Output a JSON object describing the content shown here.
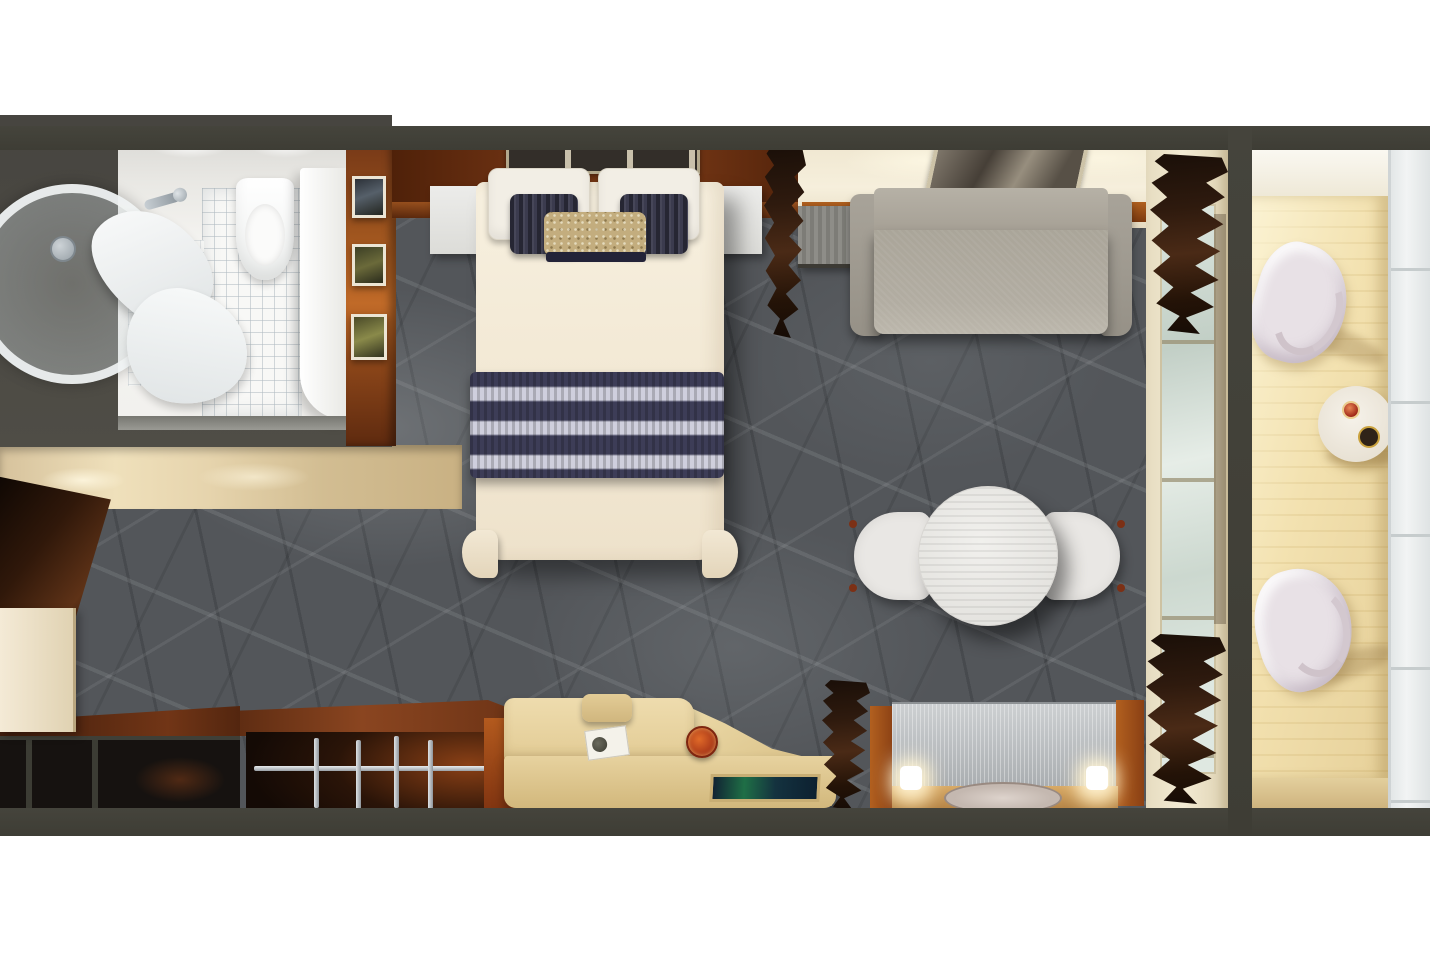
{
  "scene": {
    "kind": "3d-rendered-floor-plan",
    "view": "top-down",
    "subject": "balcony-stateroom-cabin",
    "visible_text": ""
  },
  "palette": {
    "background": "#ffffff",
    "wall": "#45443c",
    "carpet": "#54575b",
    "carpet_vein": "#9ba1a4",
    "wood_dark": "#5b2b10",
    "wood_glow": "#bb6526",
    "cream_wall": "#f1e8d2",
    "bed_linen": "#f5eedd",
    "navy_accent": "#39394e",
    "gold_accent": "#c2ac7d",
    "sofa": "#a9a399",
    "table_white": "#ebebe8",
    "deck": "#eedaa5",
    "railing": "#eef1f1",
    "glass": "#d7e1d9",
    "curtain": "#2e1b10",
    "desk_wood": "#e7d3a1",
    "vanity_metal": "#b9bdbf",
    "lamp_glow": "#fff6d8",
    "entry_floor": "#e2d2ae",
    "door_wood": "#3a1d0d",
    "screen": "#142028"
  },
  "areas": {
    "bathroom": {
      "items": [
        "curved-glass-shower",
        "towels",
        "toilet",
        "vanity-counter",
        "faucets",
        "tiled-floor",
        "ceiling-lights"
      ]
    },
    "entry": {
      "items": [
        "corridor-floor",
        "open-cabin-door",
        "wall-pillar",
        "console-shelves"
      ]
    },
    "bedroom": {
      "items": [
        "double-bed",
        "white-pillows",
        "navy-accent-pillows",
        "gold-bolster",
        "navy-striped-runner",
        "nightstand-left",
        "nightstand-right",
        "headboard-artwork",
        "gallery-wall-frames",
        "wardrobe-with-chrome-rails",
        "curtain-divider"
      ]
    },
    "sitting_area": {
      "items": [
        "sofa",
        "framed-wall-art",
        "side-cabinet",
        "round-dining-table",
        "dining-chair-left",
        "dining-chair-right",
        "desk-with-inset-tv",
        "desk-stool",
        "notebook",
        "fruit-plate",
        "vanity-dresser",
        "table-lamp-left",
        "table-lamp-right",
        "oval-floor-mat"
      ]
    },
    "balcony": {
      "items": [
        "sliding-glass-door",
        "dark-curtains",
        "wood-deck-planks",
        "balcony-chair-top",
        "balcony-chair-bottom",
        "balcony-drinks-table",
        "wine-bottle",
        "glass",
        "railing"
      ]
    }
  }
}
